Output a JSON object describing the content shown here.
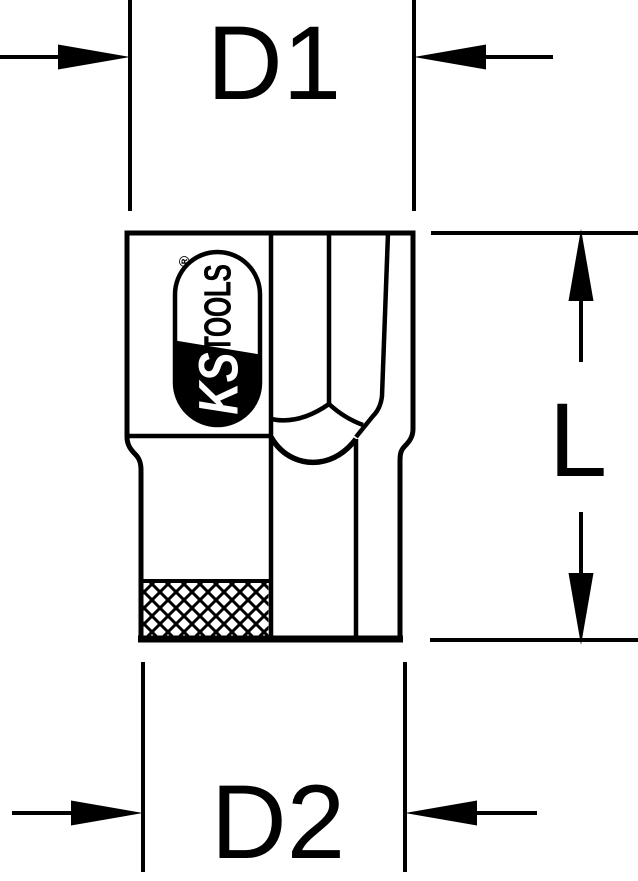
{
  "drawing": {
    "dimensions": {
      "d1": "D1",
      "d2": "D2",
      "length": "L"
    },
    "logo": {
      "ks": "KS",
      "tools": "TOOLS",
      "registered": "®"
    },
    "colors": {
      "line": "#000000",
      "background": "#ffffff"
    }
  }
}
